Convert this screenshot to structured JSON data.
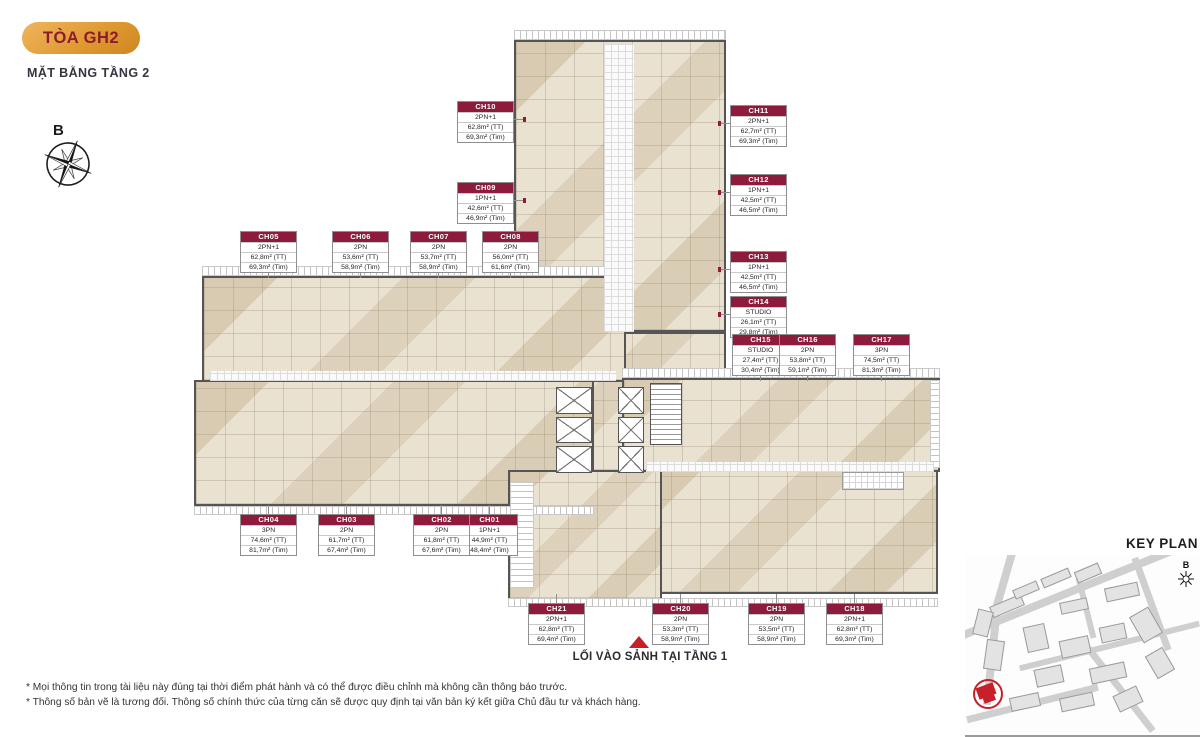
{
  "header": {
    "badge_label": "TÒA GH2",
    "subtitle": "MẶT BẰNG TẦNG 2"
  },
  "compass": {
    "label": "B"
  },
  "units": [
    {
      "code": "CH01",
      "type": "1PN+1",
      "area_tt": "44,9m² (TT)",
      "area_tim": "48,4m² (Tim)"
    },
    {
      "code": "CH02",
      "type": "2PN",
      "area_tt": "61,8m² (TT)",
      "area_tim": "67,6m² (Tim)"
    },
    {
      "code": "CH03",
      "type": "2PN",
      "area_tt": "61,7m² (TT)",
      "area_tim": "67,4m² (Tim)"
    },
    {
      "code": "CH04",
      "type": "3PN",
      "area_tt": "74,6m² (TT)",
      "area_tim": "81,7m² (Tim)"
    },
    {
      "code": "CH05",
      "type": "2PN+1",
      "area_tt": "62,8m² (TT)",
      "area_tim": "69,3m² (Tim)"
    },
    {
      "code": "CH06",
      "type": "2PN",
      "area_tt": "53,6m² (TT)",
      "area_tim": "58,9m² (Tim)"
    },
    {
      "code": "CH07",
      "type": "2PN",
      "area_tt": "53,7m² (TT)",
      "area_tim": "58,9m² (Tim)"
    },
    {
      "code": "CH08",
      "type": "2PN",
      "area_tt": "56,0m² (TT)",
      "area_tim": "61,6m² (Tim)"
    },
    {
      "code": "CH09",
      "type": "1PN+1",
      "area_tt": "42,6m² (TT)",
      "area_tim": "46,9m² (Tim)"
    },
    {
      "code": "CH10",
      "type": "2PN+1",
      "area_tt": "62,8m² (TT)",
      "area_tim": "69,3m² (Tim)"
    },
    {
      "code": "CH11",
      "type": "2PN+1",
      "area_tt": "62,7m² (TT)",
      "area_tim": "69,3m² (Tim)"
    },
    {
      "code": "CH12",
      "type": "1PN+1",
      "area_tt": "42,5m² (TT)",
      "area_tim": "46,5m² (Tim)"
    },
    {
      "code": "CH13",
      "type": "1PN+1",
      "area_tt": "42,5m² (TT)",
      "area_tim": "46,5m² (Tim)"
    },
    {
      "code": "CH14",
      "type": "STUDIO",
      "area_tt": "26,1m² (TT)",
      "area_tim": "29,8m² (Tim)"
    },
    {
      "code": "CH15",
      "type": "STUDIO",
      "area_tt": "27,4m² (TT)",
      "area_tim": "30,4m² (Tim)"
    },
    {
      "code": "CH16",
      "type": "2PN",
      "area_tt": "53,8m² (TT)",
      "area_tim": "59,1m² (Tim)"
    },
    {
      "code": "CH17",
      "type": "3PN",
      "area_tt": "74,5m² (TT)",
      "area_tim": "81,3m² (Tim)"
    },
    {
      "code": "CH18",
      "type": "2PN+1",
      "area_tt": "62,8m² (TT)",
      "area_tim": "69,3m² (Tim)"
    },
    {
      "code": "CH19",
      "type": "2PN",
      "area_tt": "53,5m² (TT)",
      "area_tim": "58,9m² (Tim)"
    },
    {
      "code": "CH20",
      "type": "2PN",
      "area_tt": "53,3m² (TT)",
      "area_tim": "58,9m² (Tim)"
    },
    {
      "code": "CH21",
      "type": "2PN+1",
      "area_tt": "62,8m² (TT)",
      "area_tim": "69,4m² (Tim)"
    }
  ],
  "entrance_label": "LỐI VÀO SẢNH TẠI TẦNG 1",
  "footnotes": [
    "* Mọi thông tin trong tài liệu này đúng tại thời điểm phát hành và có thể được điều chỉnh mà không cần thông báo trước.",
    "* Thông số bản vẽ là tương đối. Thông số chính thức của từng căn sẽ được quy định tại văn bản ký kết giữa Chủ đầu tư và khách hàng."
  ],
  "keyplan": {
    "title": "KEY PLAN",
    "compass_label": "B"
  },
  "colors": {
    "maroon": "#8E1B3C",
    "badge_gold": "#E09A33",
    "arrow_red": "#C42127",
    "room_fill": "#EAE2D1",
    "wall": "#555555"
  }
}
